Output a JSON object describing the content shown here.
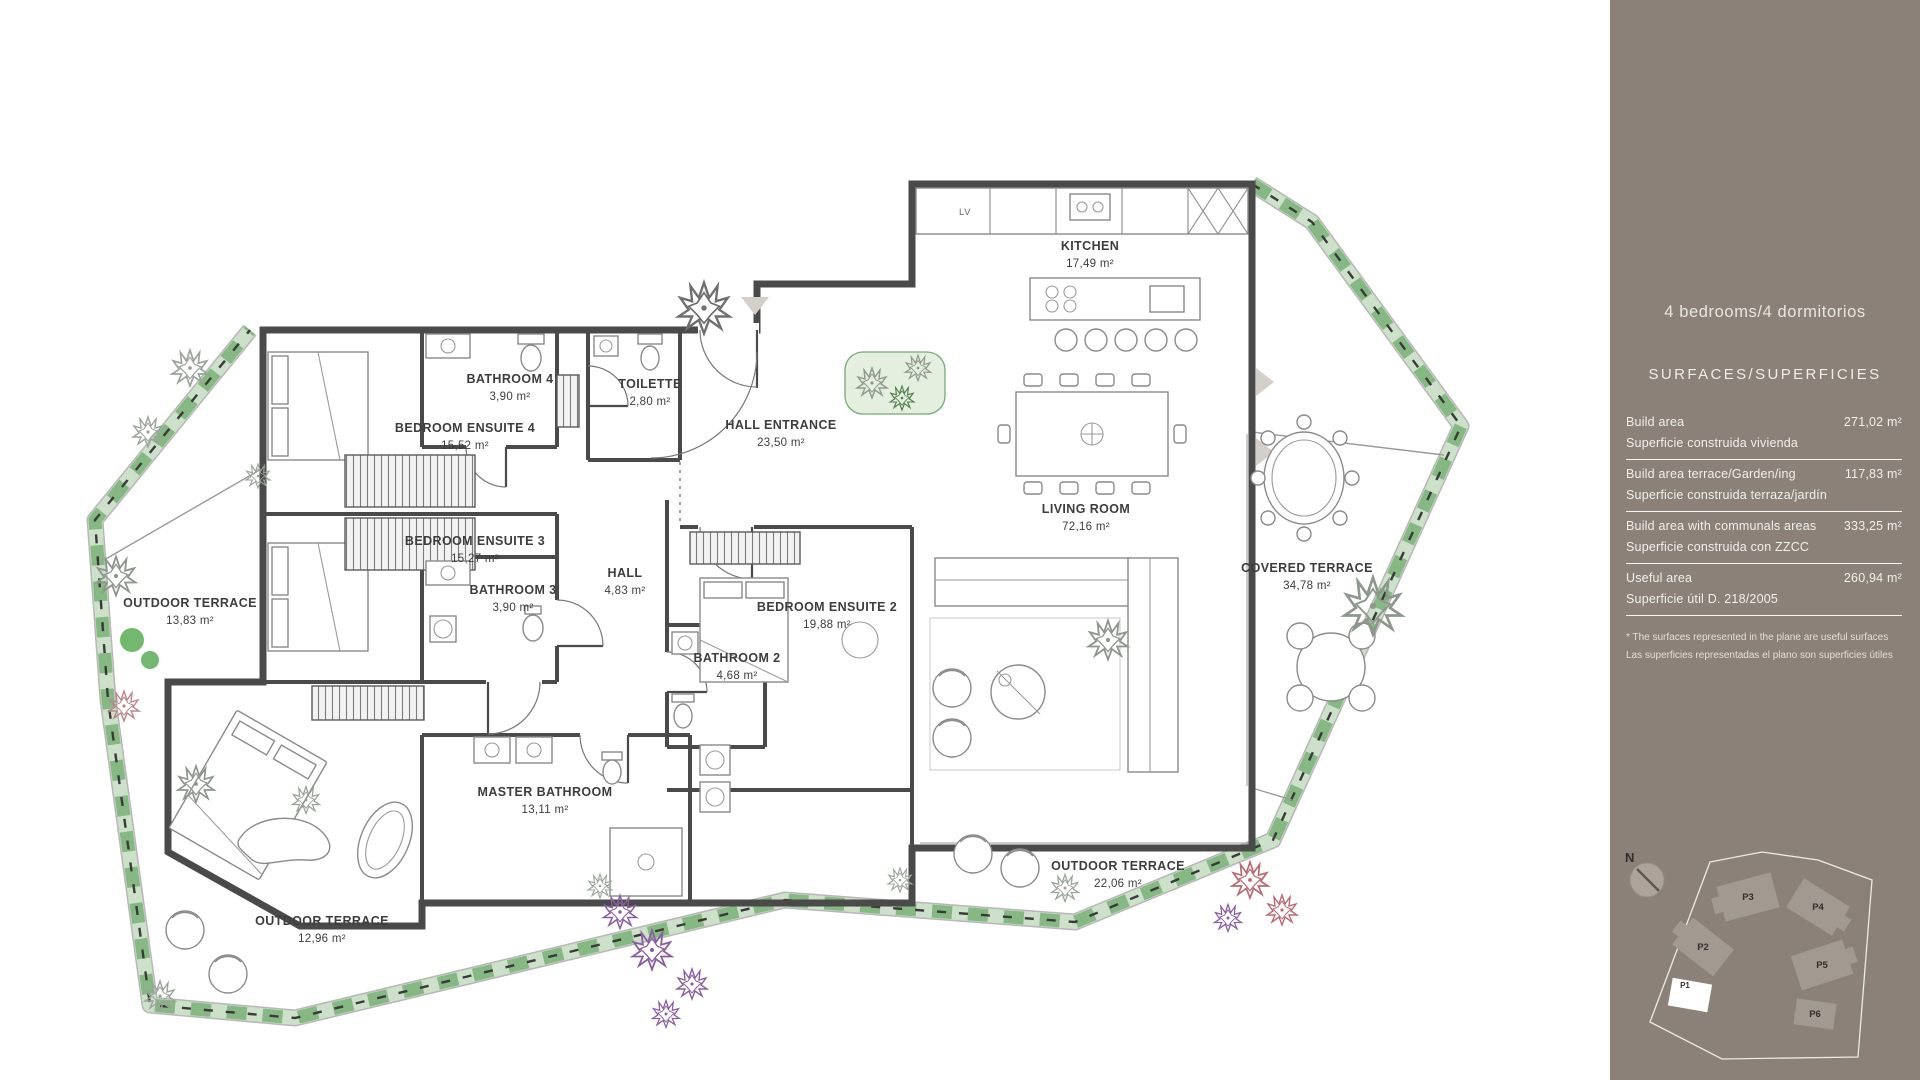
{
  "sidebar": {
    "title": "4 bedrooms/4 dormitorios",
    "subtitle": "SURFACES/SUPERFICIES",
    "rows": [
      {
        "label_en": "Build area",
        "label_es": "Superficie construida vivienda",
        "value": "271,02 m²"
      },
      {
        "label_en": "Build area terrace/Garden/ing",
        "label_es": "Superficie construida terraza/jardín",
        "value": "117,83 m²"
      },
      {
        "label_en": "Build area with communals areas",
        "label_es": "Superficie construida con ZZCC",
        "value": "333,25 m²"
      },
      {
        "label_en": "Useful area",
        "label_es": "Superficie útil  D. 218/2005",
        "value": "260,94 m²"
      }
    ],
    "footnote_en": "* The surfaces represented in the plane are useful surfaces",
    "footnote_es": "Las superficies representadas  el plano son superficies útiles",
    "compass_label": "N",
    "site_plan": {
      "buildings": [
        "P2",
        "P3",
        "P4",
        "P5",
        "P6"
      ],
      "highlighted": "P1"
    },
    "colors": {
      "background": "#8b8178",
      "text": "#f2efeb"
    }
  },
  "plan": {
    "rooms": [
      {
        "id": "kitchen",
        "name": "KITCHEN",
        "area": "17,49 m²"
      },
      {
        "id": "living-room",
        "name": "LIVING ROOM",
        "area": "72,16 m²"
      },
      {
        "id": "hall-entrance",
        "name": "HALL ENTRANCE",
        "area": "23,50 m²"
      },
      {
        "id": "toilette",
        "name": "TOILETTE",
        "area": "2,80 m²"
      },
      {
        "id": "bathroom-4",
        "name": "BATHROOM 4",
        "area": "3,90 m²"
      },
      {
        "id": "bedroom-ensuite-4",
        "name": "BEDROOM ENSUITE 4",
        "area": "15,52 m²"
      },
      {
        "id": "bedroom-ensuite-3",
        "name": "BEDROOM ENSUITE 3",
        "area": "15,27 m²"
      },
      {
        "id": "bathroom-3",
        "name": "BATHROOM 3",
        "area": "3,90 m²"
      },
      {
        "id": "hall",
        "name": "HALL",
        "area": "4,83 m²"
      },
      {
        "id": "bedroom-ensuite-2",
        "name": "BEDROOM ENSUITE 2",
        "area": "19,88 m²"
      },
      {
        "id": "bathroom-2",
        "name": "BATHROOM 2",
        "area": "4,68 m²"
      },
      {
        "id": "master-bathroom",
        "name": "MASTER BATHROOM",
        "area": "13,11 m²"
      },
      {
        "id": "covered-terrace",
        "name": "COVERED TERRACE",
        "area": "34,78 m²"
      },
      {
        "id": "outdoor-terrace-left",
        "name": "OUTDOOR TERRACE",
        "area": "13,83 m²"
      },
      {
        "id": "outdoor-terrace-right",
        "name": "OUTDOOR TERRACE",
        "area": "22,06 m²"
      },
      {
        "id": "outdoor-terrace-bottom",
        "name": "OUTDOOR TERRACE",
        "area": "12,96 m²"
      }
    ],
    "labels": {
      "kitchen_appliance": "LV"
    }
  }
}
